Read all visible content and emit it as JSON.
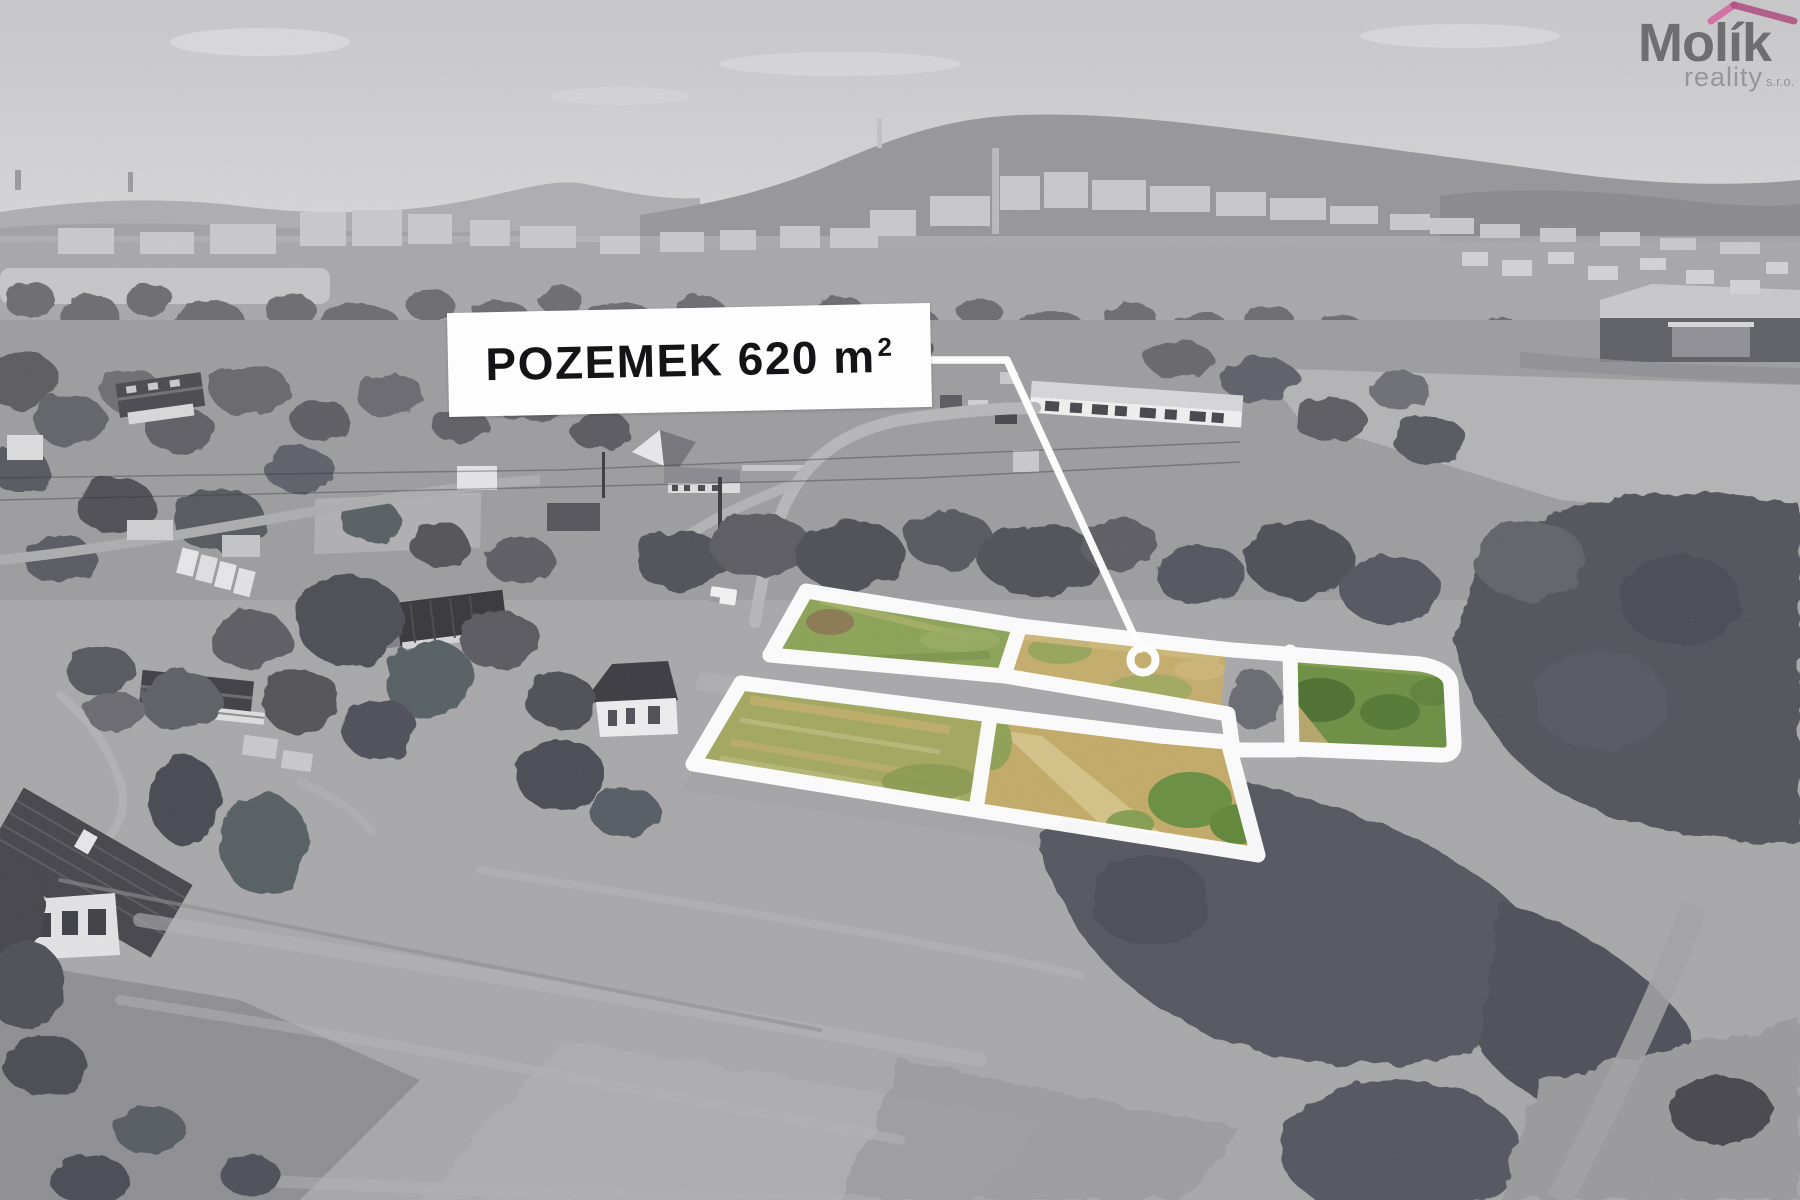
{
  "callout": {
    "label_main": "POZEMEK 620 m",
    "label_exponent": "2",
    "full_text": "POZEMEK 620 m²",
    "box_color": "#fdfdfe",
    "text_color": "#141417",
    "marker_icon": "location-ring-icon",
    "line_color": "#ffffff"
  },
  "watermark": {
    "brand": "Molík",
    "line2": "reality",
    "suffix": "s.r.o.",
    "roof_icon": "roof-icon",
    "roof_color_left": "#d3589a",
    "roof_color_right": "#aa3c74",
    "brand_color": "#55555a",
    "secondary_color": "#97979c"
  },
  "highlight": {
    "outline_color": "#ffffff",
    "plot_count": 5,
    "plot_fill_green": "#8ba357",
    "plot_fill_tan": "#c4ad6c",
    "plot_fill_dark_green": "#6c8f43"
  }
}
